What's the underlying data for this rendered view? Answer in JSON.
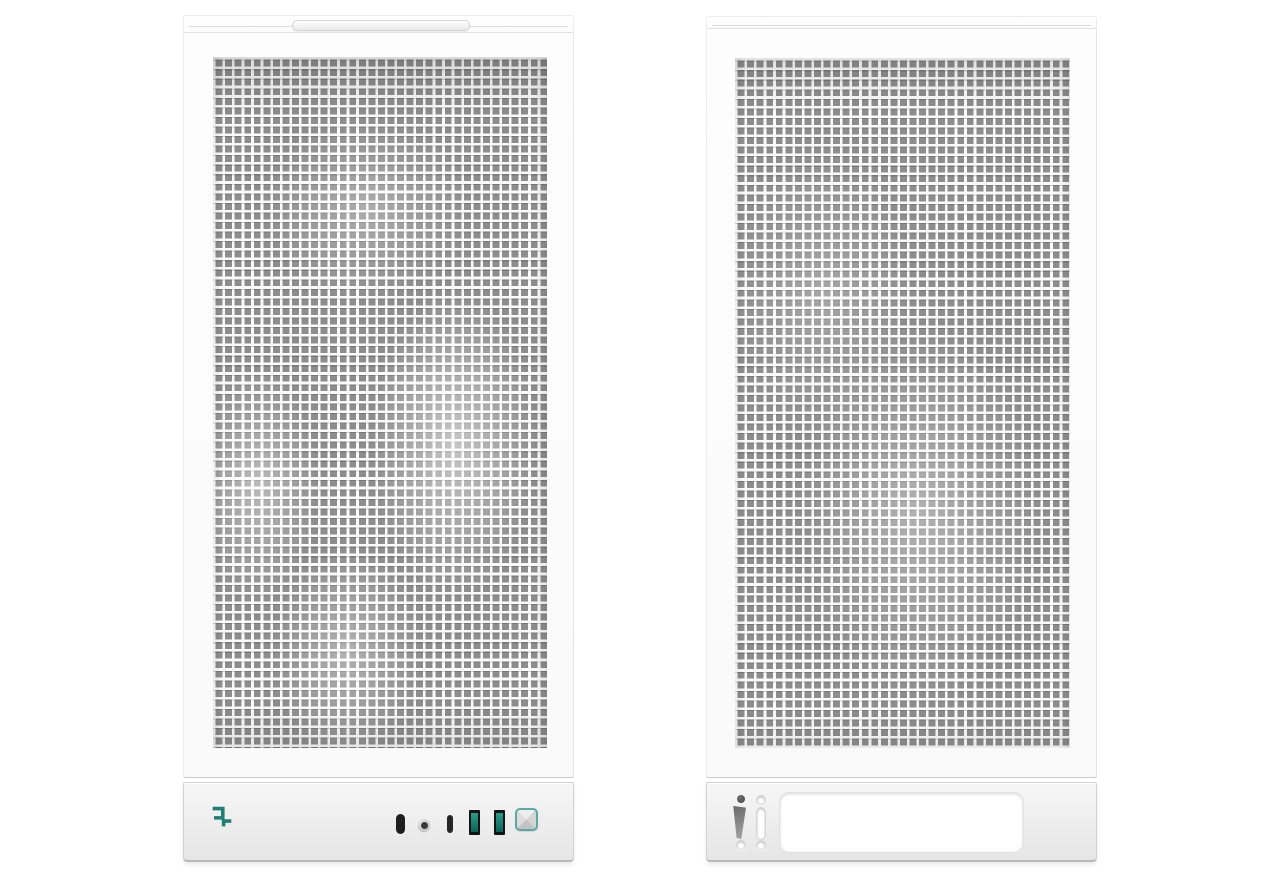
{
  "scene": {
    "background_color": "#ffffff",
    "subject": "Two white tower PC cases with square-hole mesh panels, front view (left) and rear view (right)",
    "visible_text": ""
  },
  "accent_color": "#1E8075",
  "left_case": {
    "aria": "PC case front view with mesh panel and front I/O",
    "top": {
      "handle": "recessed-lip-handle"
    },
    "mesh": {
      "hole_color": "#8d8d8d",
      "frame_color": "#fbfbfb"
    },
    "io_panel": {
      "logo_icon": "deepcool-logo",
      "logo_color": "#1E8075",
      "ports": [
        {
          "name": "usb-c-port",
          "color": "#1f1f1f"
        },
        {
          "name": "headphone-jack",
          "color": "#3a3a3a"
        },
        {
          "name": "reset-slot",
          "color": "#262626"
        },
        {
          "name": "usb-a-port",
          "accent": "#17796c"
        },
        {
          "name": "usb-a-port",
          "accent": "#17796c"
        },
        {
          "name": "power-button",
          "border_color": "#5BA9A1"
        }
      ]
    }
  },
  "right_case": {
    "aria": "PC case rear view with mesh panel and bottom cutout panel",
    "mesh": {
      "hole_color": "#8d8d8d",
      "frame_color": "#fbfbfb"
    },
    "bottom_panel": {
      "cutouts": [
        {
          "name": "thumbscrew-hole",
          "color": "#4f4f4f"
        },
        {
          "name": "latch-wedge-cutout",
          "color": "#7a7a7a"
        },
        {
          "name": "screw-hole",
          "color": "#ffffff"
        },
        {
          "name": "screw-hole",
          "color": "#ffffff"
        },
        {
          "name": "expansion-slot-cutout",
          "color": "#ffffff"
        },
        {
          "name": "screw-hole",
          "color": "#ffffff"
        },
        {
          "name": "psu-cutout",
          "color": "#ffffff"
        }
      ]
    }
  }
}
